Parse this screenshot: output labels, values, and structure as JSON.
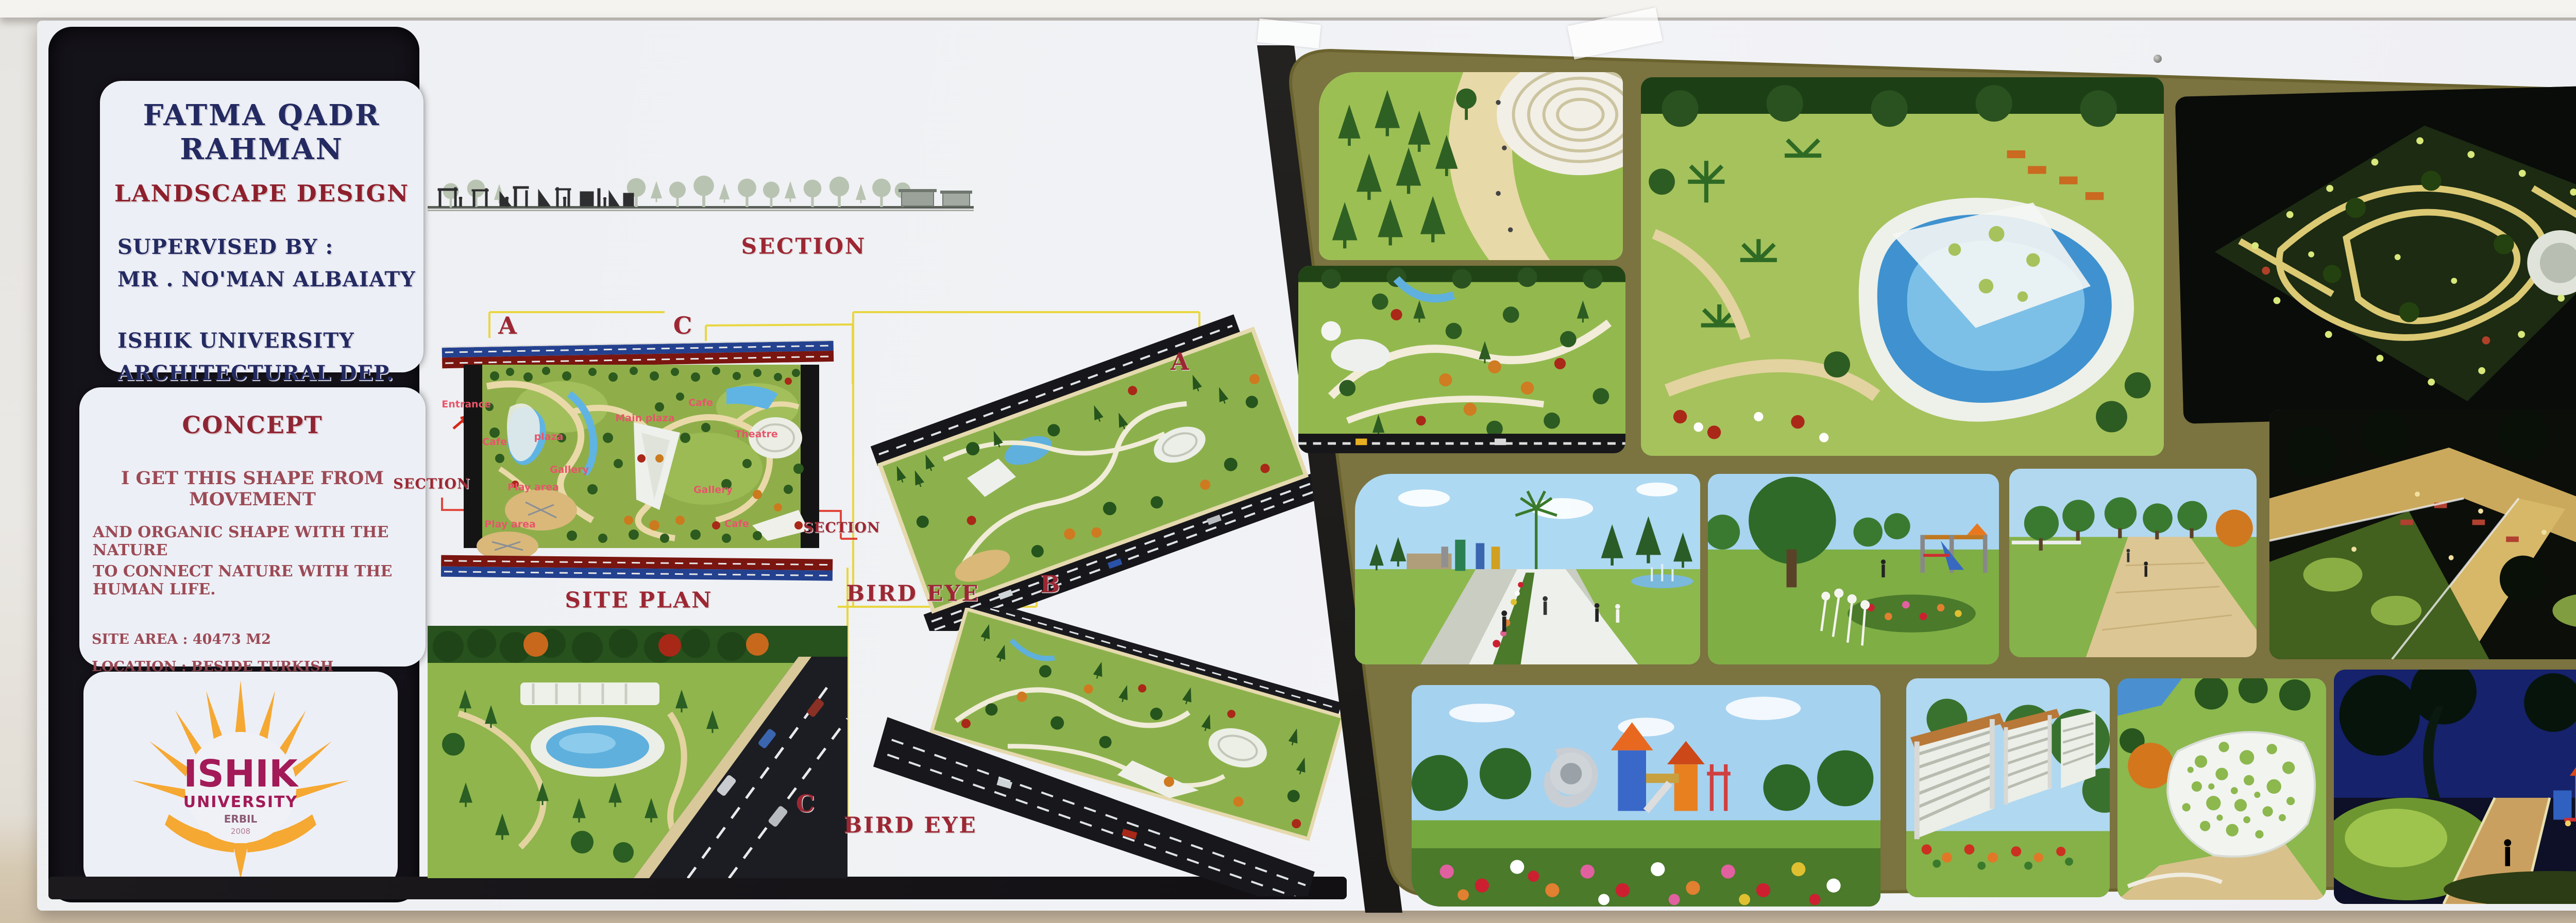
{
  "board": {
    "title_card": {
      "name": "FATMA QADR RAHMAN",
      "subtitle": "LANDSCAPE DESIGN",
      "supervised_by": "SUPERVISED BY :",
      "supervisor": "MR . NO'MAN ALBAIATY",
      "university": "ISHIK UNIVERSITY",
      "department": "ARCHITECTURAL DEP.",
      "stage": "FOURTH STAGE"
    },
    "concept_card": {
      "heading": "CONCEPT",
      "line1": "I GET THIS SHAPE FROM MOVEMENT",
      "line2": "AND ORGANIC SHAPE WITH THE NATURE",
      "line3": "TO CONNECT NATURE WITH THE HUMAN LIFE.",
      "site_area": "SITE AREA : 40473 M2",
      "location": "LOCATION : BESIDE TURKISH CONSULATE"
    },
    "logo": {
      "name": "ISHIK",
      "sub": "UNIVERSITY",
      "city": "ERBIL",
      "year": "2008"
    },
    "section": {
      "label": "SECTION"
    },
    "site_plan": {
      "label": "SITE PLAN",
      "marker_a": "A",
      "marker_c": "C",
      "section_left": "SECTION",
      "section_right": "SECTION",
      "labels": [
        {
          "text": "Entrance"
        },
        {
          "text": "Cafe"
        },
        {
          "text": "plaza"
        },
        {
          "text": "Gallery"
        },
        {
          "text": "Play area"
        },
        {
          "text": "Play area"
        },
        {
          "text": "Main plaza"
        },
        {
          "text": "Cafe"
        },
        {
          "text": "Theatre"
        },
        {
          "text": "Gallery"
        },
        {
          "text": "Cafe"
        }
      ]
    },
    "bird_eye_1": {
      "label": "BIRD EYE",
      "marker_a": "A",
      "marker_b": "B"
    },
    "bird_eye_2": {
      "label": "BIRD EYE"
    },
    "entrance_view": {
      "marker_c": "C"
    },
    "colors": {
      "accent_red": "#9c2733",
      "navy": "#232a61",
      "marker_yellow": "#e8d42e",
      "section_line_red": "#e03226",
      "olive_panel": "#7b7340",
      "black_panel": "#15131a",
      "board_white": "#eff1f4",
      "logo_orange": "#f5a832",
      "logo_magenta": "#a21a57",
      "plan_label_pink": "#e8556a",
      "wall": "#e9e7e3",
      "wall_lower": "#d5c8b1"
    }
  }
}
